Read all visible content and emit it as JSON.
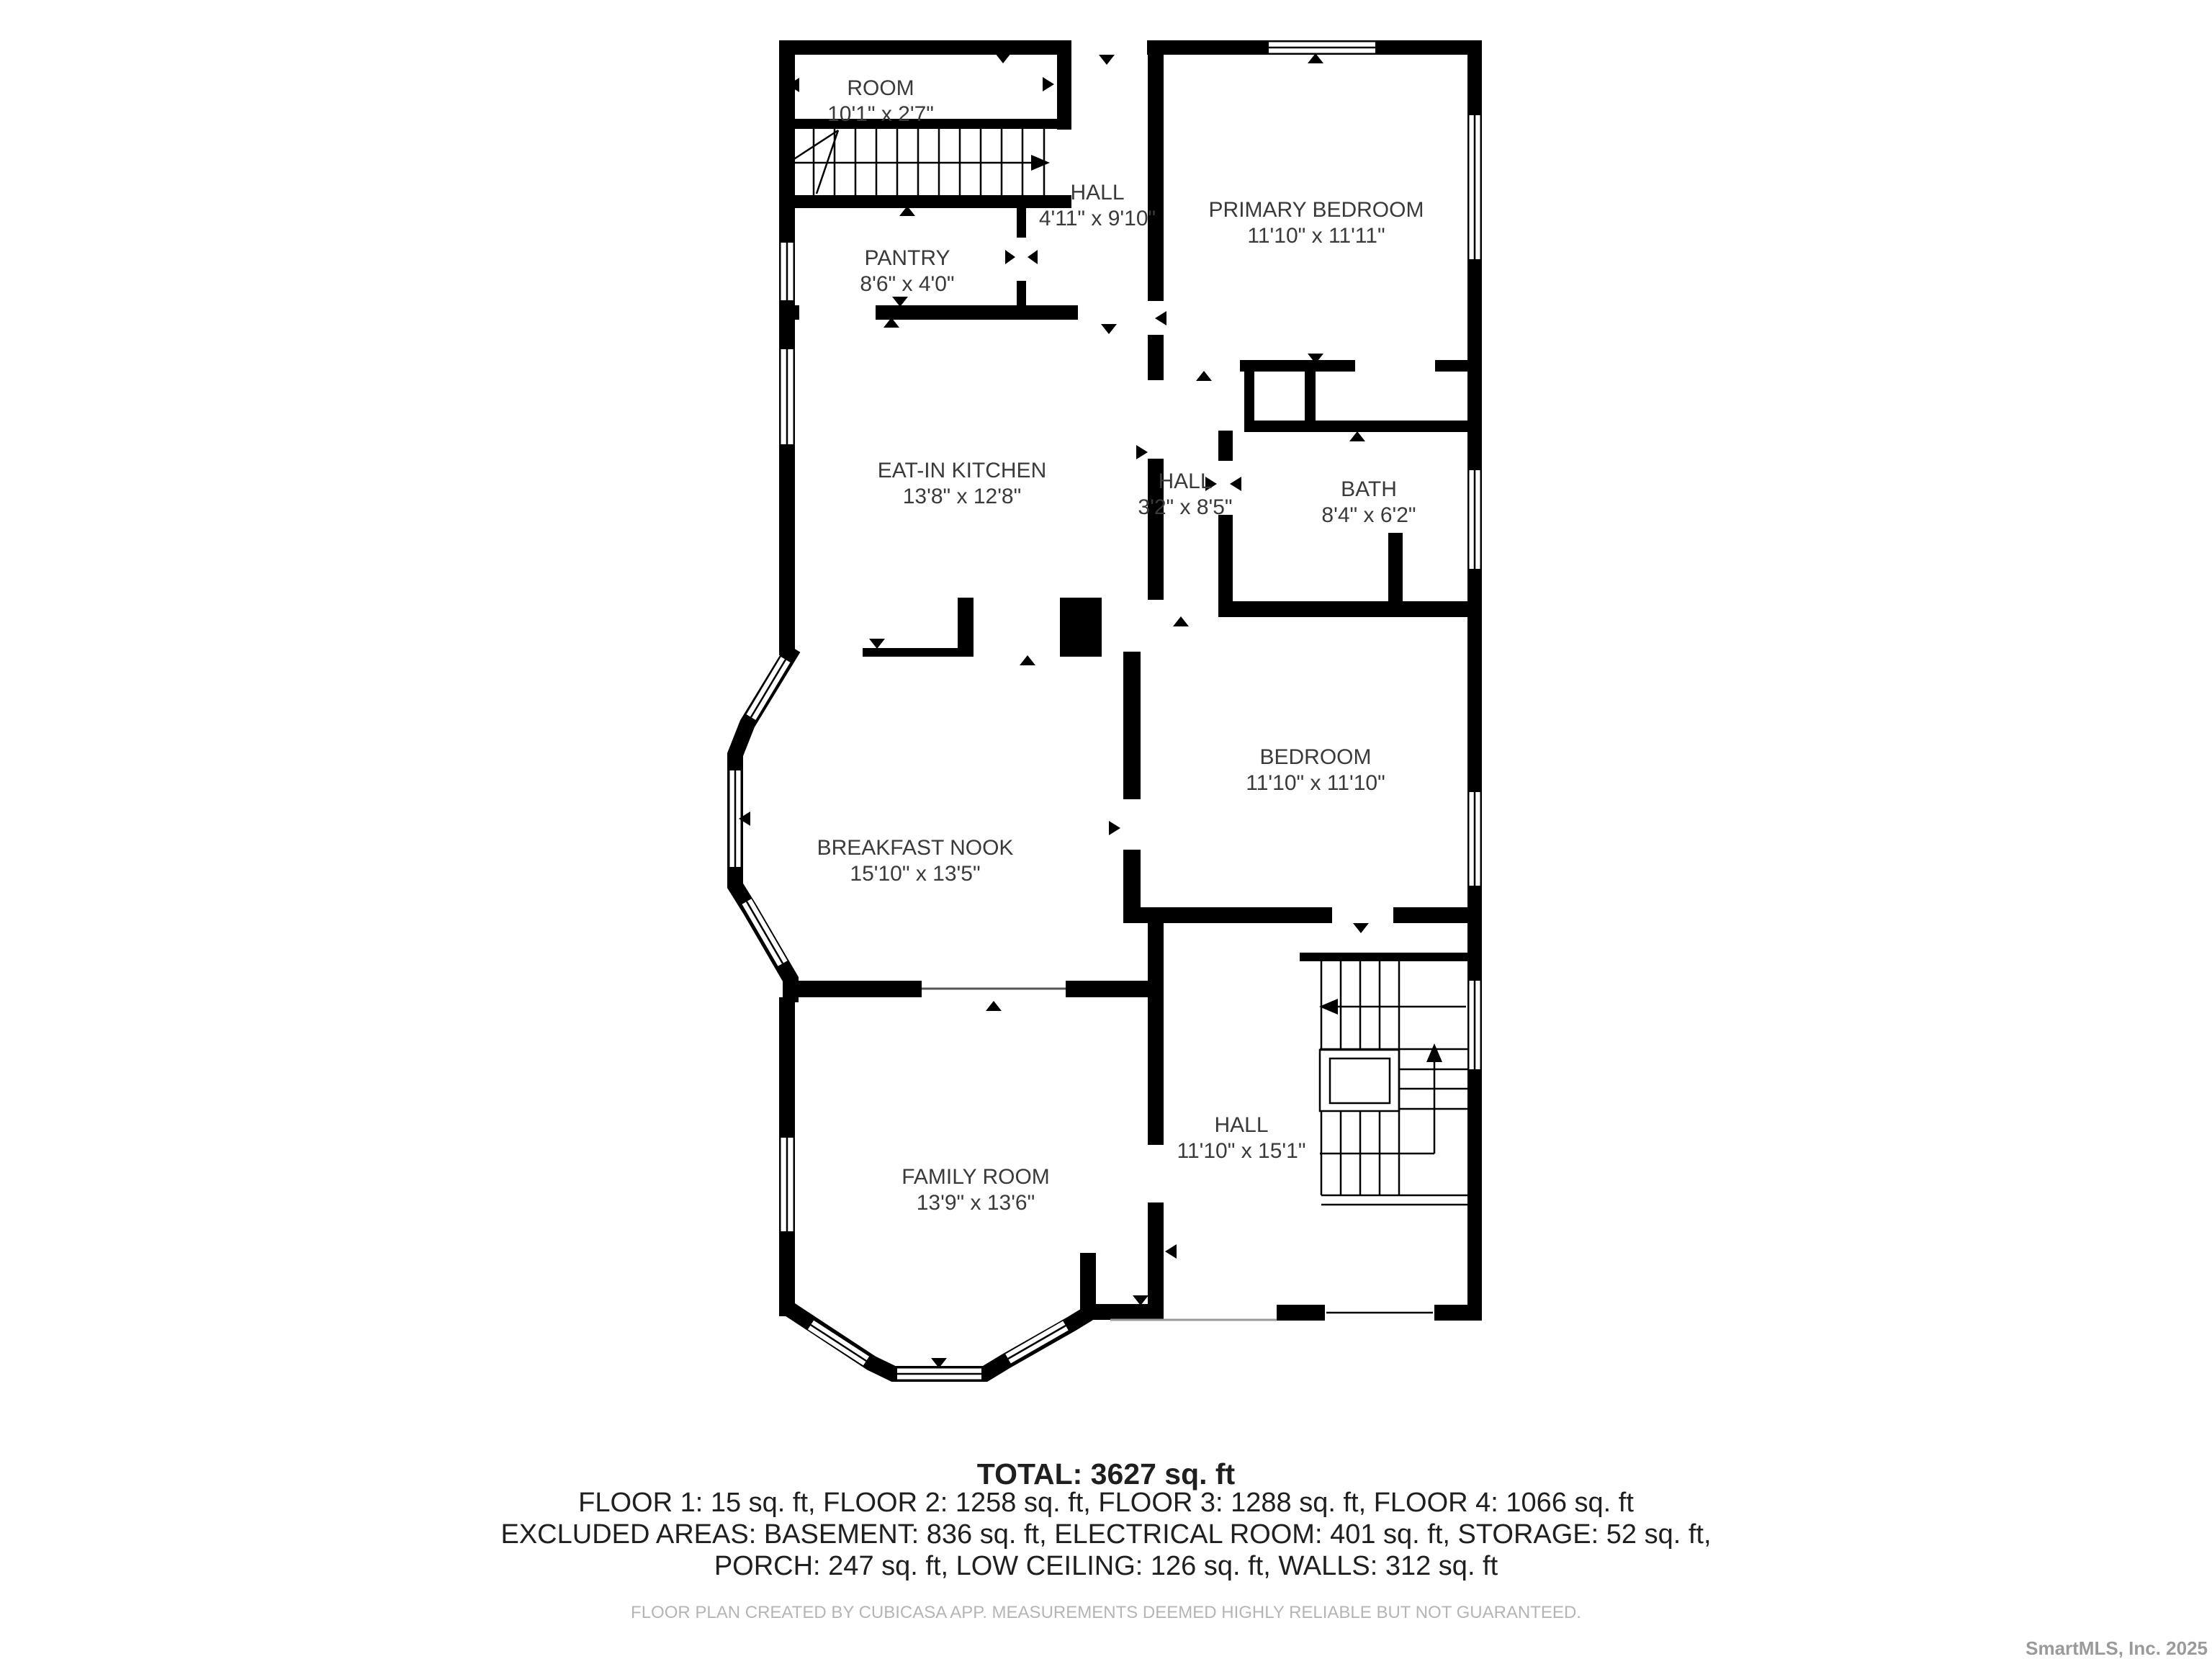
{
  "rooms": [
    {
      "id": "room",
      "name": "ROOM",
      "dims": "10'1\" x 2'7\""
    },
    {
      "id": "hall-upper",
      "name": "HALL",
      "dims": "4'11\" x 9'10\""
    },
    {
      "id": "pantry",
      "name": "PANTRY",
      "dims": "8'6\" x 4'0\""
    },
    {
      "id": "primary-bedroom",
      "name": "PRIMARY BEDROOM",
      "dims": "11'10\" x 11'11\""
    },
    {
      "id": "eat-in-kitchen",
      "name": "EAT-IN KITCHEN",
      "dims": "13'8\" x 12'8\""
    },
    {
      "id": "hall-middle",
      "name": "HALL",
      "dims": "3'2\" x 8'5\""
    },
    {
      "id": "bath",
      "name": "BATH",
      "dims": "8'4\" x 6'2\""
    },
    {
      "id": "breakfast-nook",
      "name": "BREAKFAST NOOK",
      "dims": "15'10\" x 13'5\""
    },
    {
      "id": "bedroom",
      "name": "BEDROOM",
      "dims": "11'10\" x 11'10\""
    },
    {
      "id": "family-room",
      "name": "FAMILY ROOM",
      "dims": "13'9\" x 13'6\""
    },
    {
      "id": "hall-lower",
      "name": "HALL",
      "dims": "11'10\" x 15'1\""
    }
  ],
  "summary": {
    "total": "TOTAL: 3627 sq. ft",
    "floors": "FLOOR 1: 15 sq. ft, FLOOR 2: 1258 sq. ft, FLOOR 3: 1288 sq. ft, FLOOR 4: 1066 sq. ft",
    "excluded_line1": "EXCLUDED AREAS: BASEMENT: 836 sq. ft, ELECTRICAL ROOM: 401 sq. ft, STORAGE: 52 sq. ft,",
    "excluded_line2": "PORCH: 247 sq. ft, LOW CEILING: 126 sq. ft, WALLS: 312 sq. ft",
    "disclaimer": "FLOOR PLAN CREATED BY CUBICASA APP. MEASUREMENTS DEEMED HIGHLY RELIABLE BUT NOT GUARANTEED."
  },
  "watermark": "SmartMLS, Inc.  2025",
  "colors": {
    "wall": "#000000",
    "room_text": "#3a3a3a",
    "summary_text": "#1f1f1f",
    "disclaimer_text": "#b5b5b5",
    "watermark_text": "#9a9a9a"
  },
  "icons": {
    "door_marker": "small filled triangle at wall openings",
    "stair_direction": "arrow line along stair run"
  }
}
